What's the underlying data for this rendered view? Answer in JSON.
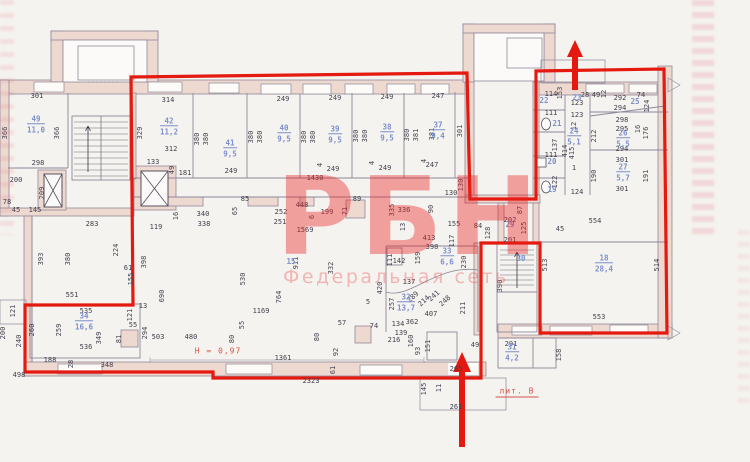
{
  "watermark": {
    "title": "РБН",
    "subtitle": "Федеральная сеть"
  },
  "notes": [
    [
      "Н = 0,97",
      218,
      351,
      false
    ],
    [
      "лит. В",
      517,
      392,
      true
    ]
  ],
  "colors": {
    "paper": "#f5f3ef",
    "wall_fill": "#eed9d0",
    "wall_line": "#8e8799",
    "window_fill": "#fcfbf8",
    "red_outline": "#e4190f",
    "watermark_red": "rgba(233,32,32,0.40)",
    "subtitle_red": "rgba(235,95,95,0.42)",
    "blue_label": "#7c90cc",
    "dim_text": "#413f4d",
    "note_red": "#d85348"
  },
  "rooms": [
    [
      "49",
      "11,0",
      36,
      124
    ],
    [
      "42",
      "11,2",
      169,
      126
    ],
    [
      "41",
      "9,5",
      230,
      148
    ],
    [
      "40",
      "9,5",
      284,
      133
    ],
    [
      "39",
      "9,5",
      335,
      134
    ],
    [
      "38",
      "9,5",
      387,
      132
    ],
    [
      "37",
      "9,4",
      438,
      130
    ],
    [
      "22",
      "",
      544,
      101
    ],
    [
      "23",
      "",
      577,
      98
    ],
    [
      "25",
      "",
      635,
      102
    ],
    [
      "21",
      "",
      557,
      124
    ],
    [
      "24",
      "5,1",
      574,
      136
    ],
    [
      "26",
      "5,5",
      623,
      138
    ],
    [
      "20",
      "",
      552,
      162
    ],
    [
      "27",
      "5,7",
      623,
      172
    ],
    [
      "19",
      "",
      552,
      190
    ],
    [
      "29",
      "",
      510,
      225
    ],
    [
      "30",
      "",
      521,
      259
    ],
    [
      "15",
      "",
      291,
      262
    ],
    [
      "32",
      "13,7",
      406,
      302
    ],
    [
      "33",
      "6,6",
      447,
      256
    ],
    [
      "34",
      "16,6",
      84,
      321
    ],
    [
      "18",
      "28,4",
      604,
      263
    ],
    [
      "31",
      "4,2",
      512,
      352
    ]
  ],
  "dims": [
    [
      "301",
      37,
      96,
      "h"
    ],
    [
      "366",
      5,
      133,
      "v"
    ],
    [
      "366",
      57,
      133,
      "v"
    ],
    [
      "298",
      38,
      163,
      "h"
    ],
    [
      "200",
      16,
      180,
      "h"
    ],
    [
      "209",
      42,
      193,
      "v"
    ],
    [
      "78",
      7,
      202,
      "h"
    ],
    [
      "45",
      16,
      210,
      "h"
    ],
    [
      "145",
      35,
      210,
      "h"
    ],
    [
      "200",
      3,
      333,
      "v"
    ],
    [
      "121",
      13,
      311,
      "v"
    ],
    [
      "551",
      72,
      295,
      "h"
    ],
    [
      "240",
      19,
      341,
      "v"
    ],
    [
      "498",
      19,
      375,
      "h"
    ],
    [
      "283",
      92,
      224,
      "h"
    ],
    [
      "314",
      168,
      100,
      "h"
    ],
    [
      "329",
      140,
      133,
      "v"
    ],
    [
      "312",
      171,
      149,
      "h"
    ],
    [
      "133",
      153,
      162,
      "h"
    ],
    [
      "181",
      185,
      173,
      "h"
    ],
    [
      "49",
      172,
      170,
      "v"
    ],
    [
      "249",
      283,
      99,
      "h"
    ],
    [
      "249",
      335,
      98,
      "h"
    ],
    [
      "249",
      387,
      97,
      "h"
    ],
    [
      "247",
      438,
      96,
      "h"
    ],
    [
      "380",
      197,
      139,
      "v"
    ],
    [
      "380",
      206,
      139,
      "v"
    ],
    [
      "380",
      251,
      137,
      "v"
    ],
    [
      "380",
      260,
      137,
      "v"
    ],
    [
      "380",
      304,
      137,
      "v"
    ],
    [
      "380",
      313,
      137,
      "v"
    ],
    [
      "380",
      356,
      136,
      "v"
    ],
    [
      "380",
      365,
      136,
      "v"
    ],
    [
      "380",
      407,
      135,
      "v"
    ],
    [
      "381",
      416,
      135,
      "v"
    ],
    [
      "381",
      432,
      134,
      "v"
    ],
    [
      "301",
      460,
      131,
      "v"
    ],
    [
      "249",
      231,
      171,
      "h"
    ],
    [
      "249",
      333,
      169,
      "h"
    ],
    [
      "249",
      385,
      168,
      "h"
    ],
    [
      "247",
      432,
      165,
      "h"
    ],
    [
      "1430",
      315,
      178,
      "h"
    ],
    [
      "4",
      320,
      165,
      "v"
    ],
    [
      "4",
      372,
      163,
      "v"
    ],
    [
      "4",
      424,
      161,
      "v"
    ],
    [
      "119",
      156,
      227,
      "h"
    ],
    [
      "16",
      176,
      216,
      "v"
    ],
    [
      "340",
      203,
      214,
      "h"
    ],
    [
      "338",
      204,
      224,
      "h"
    ],
    [
      "85",
      245,
      199,
      "h"
    ],
    [
      "65",
      235,
      211,
      "v"
    ],
    [
      "252",
      281,
      212,
      "h"
    ],
    [
      "251",
      280,
      222,
      "h"
    ],
    [
      "448",
      302,
      205,
      "h"
    ],
    [
      "6",
      312,
      217,
      "v"
    ],
    [
      "199",
      327,
      212,
      "h"
    ],
    [
      "89",
      357,
      199,
      "h"
    ],
    [
      "71",
      345,
      211,
      "v"
    ],
    [
      "1569",
      305,
      230,
      "h"
    ],
    [
      "335",
      392,
      210,
      "v"
    ],
    [
      "336",
      404,
      210,
      "h"
    ],
    [
      "13",
      403,
      227,
      "v"
    ],
    [
      "130",
      451,
      193,
      "h"
    ],
    [
      "130",
      461,
      185,
      "v"
    ],
    [
      "90",
      431,
      209,
      "v"
    ],
    [
      "155",
      454,
      224,
      "h"
    ],
    [
      "117",
      452,
      241,
      "v"
    ],
    [
      "84",
      478,
      226,
      "h"
    ],
    [
      "128",
      488,
      233,
      "v"
    ],
    [
      "87",
      520,
      210,
      "v"
    ],
    [
      "554",
      595,
      221,
      "h"
    ],
    [
      "45",
      560,
      229,
      "h"
    ],
    [
      "202",
      510,
      220,
      "h"
    ],
    [
      "201",
      510,
      240,
      "h"
    ],
    [
      "125",
      524,
      228,
      "v"
    ],
    [
      "393",
      41,
      259,
      "v"
    ],
    [
      "380",
      68,
      259,
      "v"
    ],
    [
      "224",
      116,
      250,
      "v"
    ],
    [
      "61",
      128,
      268,
      "h"
    ],
    [
      "155",
      131,
      279,
      "v"
    ],
    [
      "398",
      144,
      262,
      "v"
    ],
    [
      "690",
      162,
      296,
      "v"
    ],
    [
      "530",
      243,
      279,
      "v"
    ],
    [
      "911",
      296,
      263,
      "v"
    ],
    [
      "332",
      331,
      268,
      "v"
    ],
    [
      "764",
      279,
      297,
      "v"
    ],
    [
      "1169",
      261,
      311,
      "h"
    ],
    [
      "503",
      158,
      337,
      "h"
    ],
    [
      "480",
      191,
      337,
      "h"
    ],
    [
      "80",
      232,
      339,
      "v"
    ],
    [
      "55",
      242,
      325,
      "v"
    ],
    [
      "57",
      342,
      323,
      "h"
    ],
    [
      "74",
      374,
      326,
      "h"
    ],
    [
      "80",
      317,
      337,
      "v"
    ],
    [
      "92",
      336,
      352,
      "v"
    ],
    [
      "1361",
      283,
      358,
      "h"
    ],
    [
      "61",
      333,
      370,
      "v"
    ],
    [
      "2323",
      311,
      381,
      "h"
    ],
    [
      "5",
      368,
      302,
      "h"
    ],
    [
      "257",
      392,
      304,
      "v"
    ],
    [
      "420",
      380,
      288,
      "v"
    ],
    [
      "413",
      429,
      238,
      "h"
    ],
    [
      "398",
      432,
      247,
      "h"
    ],
    [
      "142",
      399,
      261,
      "h"
    ],
    [
      "111",
      390,
      260,
      "v"
    ],
    [
      "159",
      418,
      258,
      "v"
    ],
    [
      "137",
      409,
      282,
      "h"
    ],
    [
      "289",
      413,
      297,
      "d"
    ],
    [
      "214",
      424,
      301,
      "d"
    ],
    [
      "241",
      434,
      296,
      "d"
    ],
    [
      "248",
      445,
      301,
      "d"
    ],
    [
      "407",
      431,
      314,
      "h"
    ],
    [
      "362",
      412,
      322,
      "h"
    ],
    [
      "134",
      398,
      324,
      "h"
    ],
    [
      "139",
      401,
      333,
      "h"
    ],
    [
      "216",
      394,
      340,
      "h"
    ],
    [
      "160",
      411,
      341,
      "v"
    ],
    [
      "93",
      418,
      351,
      "v"
    ],
    [
      "151",
      428,
      346,
      "v"
    ],
    [
      "230",
      464,
      262,
      "v"
    ],
    [
      "211",
      463,
      308,
      "v"
    ],
    [
      "535",
      86,
      311,
      "h"
    ],
    [
      "260",
      32,
      330,
      "v"
    ],
    [
      "259",
      59,
      330,
      "v"
    ],
    [
      "349",
      99,
      338,
      "v"
    ],
    [
      "536",
      86,
      347,
      "h"
    ],
    [
      "188",
      50,
      360,
      "h"
    ],
    [
      "28",
      71,
      364,
      "v"
    ],
    [
      "348",
      107,
      365,
      "h"
    ],
    [
      "13",
      143,
      306,
      "h"
    ],
    [
      "121",
      130,
      315,
      "v"
    ],
    [
      "55",
      133,
      325,
      "h"
    ],
    [
      "81",
      119,
      339,
      "v"
    ],
    [
      "294",
      145,
      333,
      "v"
    ],
    [
      "553",
      599,
      317,
      "h"
    ],
    [
      "513",
      545,
      265,
      "v"
    ],
    [
      "514",
      657,
      265,
      "v"
    ],
    [
      "291",
      511,
      344,
      "h"
    ],
    [
      "158",
      559,
      355,
      "v"
    ],
    [
      "49",
      475,
      345,
      "h"
    ],
    [
      "390",
      500,
      286,
      "v"
    ],
    [
      "145",
      424,
      389,
      "v"
    ],
    [
      "11",
      439,
      388,
      "v"
    ],
    [
      "261",
      456,
      407,
      "h"
    ],
    [
      "265",
      456,
      369,
      "h"
    ],
    [
      "114",
      551,
      94,
      "h"
    ],
    [
      "153",
      560,
      93,
      "v"
    ],
    [
      "28",
      585,
      95,
      "h"
    ],
    [
      "49",
      596,
      95,
      "h"
    ],
    [
      "12",
      604,
      94,
      "v"
    ],
    [
      "292",
      620,
      98,
      "h"
    ],
    [
      "294",
      620,
      108,
      "h"
    ],
    [
      "74",
      641,
      95,
      "h"
    ],
    [
      "124",
      647,
      106,
      "v"
    ],
    [
      "123",
      577,
      103,
      "h"
    ],
    [
      "123",
      577,
      115,
      "h"
    ],
    [
      "12",
      574,
      126,
      "v"
    ],
    [
      "298",
      622,
      120,
      "h"
    ],
    [
      "295",
      622,
      129,
      "h"
    ],
    [
      "16",
      638,
      129,
      "v"
    ],
    [
      "176",
      646,
      133,
      "v"
    ],
    [
      "212",
      594,
      136,
      "v"
    ],
    [
      "294",
      622,
      149,
      "h"
    ],
    [
      "301",
      622,
      160,
      "h"
    ],
    [
      "190",
      594,
      176,
      "v"
    ],
    [
      "191",
      646,
      176,
      "v"
    ],
    [
      "301",
      622,
      189,
      "h"
    ],
    [
      "124",
      577,
      192,
      "h"
    ],
    [
      "414",
      565,
      151,
      "v"
    ],
    [
      "415",
      572,
      153,
      "v"
    ],
    [
      "1",
      574,
      168,
      "h"
    ],
    [
      "111",
      551,
      113,
      "h"
    ],
    [
      "137",
      555,
      145,
      "v"
    ],
    [
      "111",
      551,
      155,
      "h"
    ],
    [
      "122",
      555,
      182,
      "v"
    ]
  ]
}
